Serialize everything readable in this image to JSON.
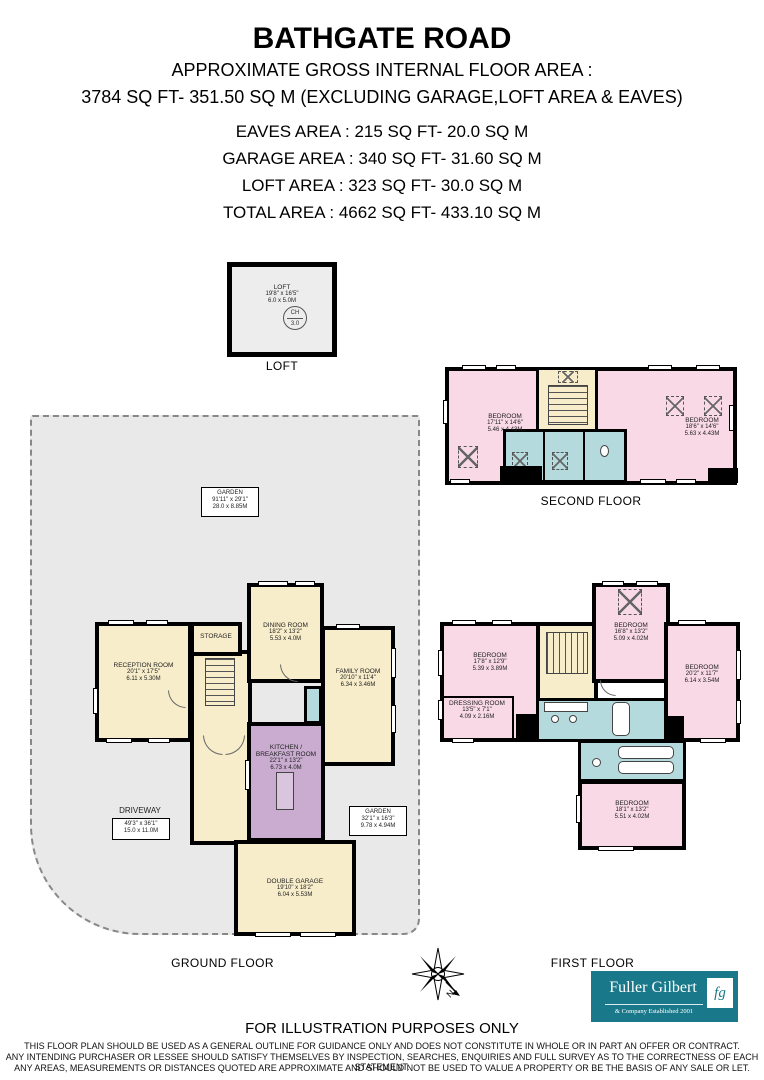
{
  "header": {
    "title": "BATHGATE ROAD",
    "lines": [
      "APPROXIMATE GROSS INTERNAL FLOOR AREA :",
      "3784 SQ FT-  351.50 SQ M (EXCLUDING GARAGE,LOFT AREA & EAVES)",
      "EAVES AREA : 215 SQ FT-  20.0 SQ M",
      "GARAGE AREA : 340 SQ FT-  31.60 SQ M",
      "LOFT AREA : 323 SQ FT-  30.0 SQ M",
      "TOTAL AREA : 4662 SQ FT-  433.10 SQ M"
    ]
  },
  "loft": {
    "caption": "LOFT",
    "room": {
      "name": "LOFT",
      "imperial": "19'8\" x 16'5\"",
      "metric": "6.0 x 5.0M"
    },
    "ch_top": "CH",
    "ch_value": "3.0"
  },
  "second_floor": {
    "caption": "SECOND FLOOR",
    "bedroom_left": {
      "name": "BEDROOM",
      "imperial": "17'11\" x 14'6\"",
      "metric": "5.46 x 4.43M"
    },
    "bedroom_right": {
      "name": "BEDROOM",
      "imperial": "18'6\" x 14'6\"",
      "metric": "5.63 x 4.43M"
    }
  },
  "ground_floor": {
    "caption": "GROUND FLOOR",
    "garden_top": {
      "name": "GARDEN",
      "imperial": "91'11\" x 29'1\"",
      "metric": "28.0 x 8.85M"
    },
    "driveway": {
      "name": "DRIVEWAY",
      "imperial": "49'3\" x 36'1\"",
      "metric": "15.0 x 11.0M"
    },
    "garden_right": {
      "name": "GARDEN",
      "imperial": "32'1\" x 16'3\"",
      "metric": "9.78 x 4.94M"
    },
    "reception": {
      "name": "RECEPTION ROOM",
      "imperial": "20'1\" x 17'5\"",
      "metric": "6.11 x 5.30M"
    },
    "storage": {
      "name": "STORAGE"
    },
    "dining": {
      "name": "DINING ROOM",
      "imperial": "18'2\" x 13'2\"",
      "metric": "5.53 x 4.0M"
    },
    "family": {
      "name": "FAMILY ROOM",
      "imperial": "20'10\" x 11'4\"",
      "metric": "6.34 x 3.46M"
    },
    "kitchen": {
      "name1": "KITCHEN /",
      "name2": "BREAKFAST ROOM",
      "imperial": "22'1\" x 13'2\"",
      "metric": "6.73 x 4.0M"
    },
    "garage": {
      "name": "DOUBLE GARAGE",
      "imperial": "19'10\" x 18'2\"",
      "metric": "6.04 x 5.53M"
    }
  },
  "first_floor": {
    "caption": "FIRST FLOOR",
    "bedroom_left": {
      "name": "BEDROOM",
      "imperial": "17'8\" x 12'9\"",
      "metric": "5.39 x 3.89M"
    },
    "dressing": {
      "name": "DRESSING ROOM",
      "imperial": "13'5\" x 7'1\"",
      "metric": "4.09 x 2.16M"
    },
    "bedroom_top": {
      "name": "BEDROOM",
      "imperial": "16'8\" x 13'2\"",
      "metric": "5.09 x 4.02M"
    },
    "bedroom_right": {
      "name": "BEDROOM",
      "imperial": "20'2\" x 11'7\"",
      "metric": "6.14 x 3.54M"
    },
    "bedroom_bottom": {
      "name": "BEDROOM",
      "imperial": "18'1\" x 13'2\"",
      "metric": "5.51 x 4.02M"
    }
  },
  "compass": {
    "north_label": "N"
  },
  "logo": {
    "name": "Fuller Gilbert",
    "tagline": "& Company Established 2001",
    "monogram": "fg"
  },
  "footer": {
    "heading": "FOR ILLUSTRATION PURPOSES ONLY",
    "lines": [
      "THIS FLOOR PLAN SHOULD BE USED AS A GENERAL OUTLINE FOR GUIDANCE ONLY AND DOES NOT CONSTITUTE IN WHOLE OR IN PART AN OFFER OR CONTRACT.",
      "ANY INTENDING PURCHASER OR LESSEE SHOULD SATISFY THEMSELVES BY INSPECTION, SEARCHES, ENQUIRIES AND FULL SURVEY AS TO THE CORRECTNESS OF EACH STATEMENT.",
      "ANY AREAS, MEASUREMENTS OR DISTANCES QUOTED ARE APPROXIMATE AND SHOULD NOT BE USED TO VALUE A PROPERTY OR BE THE BASIS OF ANY SALE OR LET."
    ]
  },
  "colors": {
    "bedroom_pink": "#f9d9e6",
    "hall_cream": "#f8edcb",
    "bath_blue": "#b5dade",
    "kitchen_mauve": "#c9accf",
    "ground_cream": "#f8edcb",
    "outdoor_gray": "#e9e9e9",
    "loft_gray": "#ededed",
    "wall_black": "#000000",
    "logo_teal": "#19798a"
  }
}
